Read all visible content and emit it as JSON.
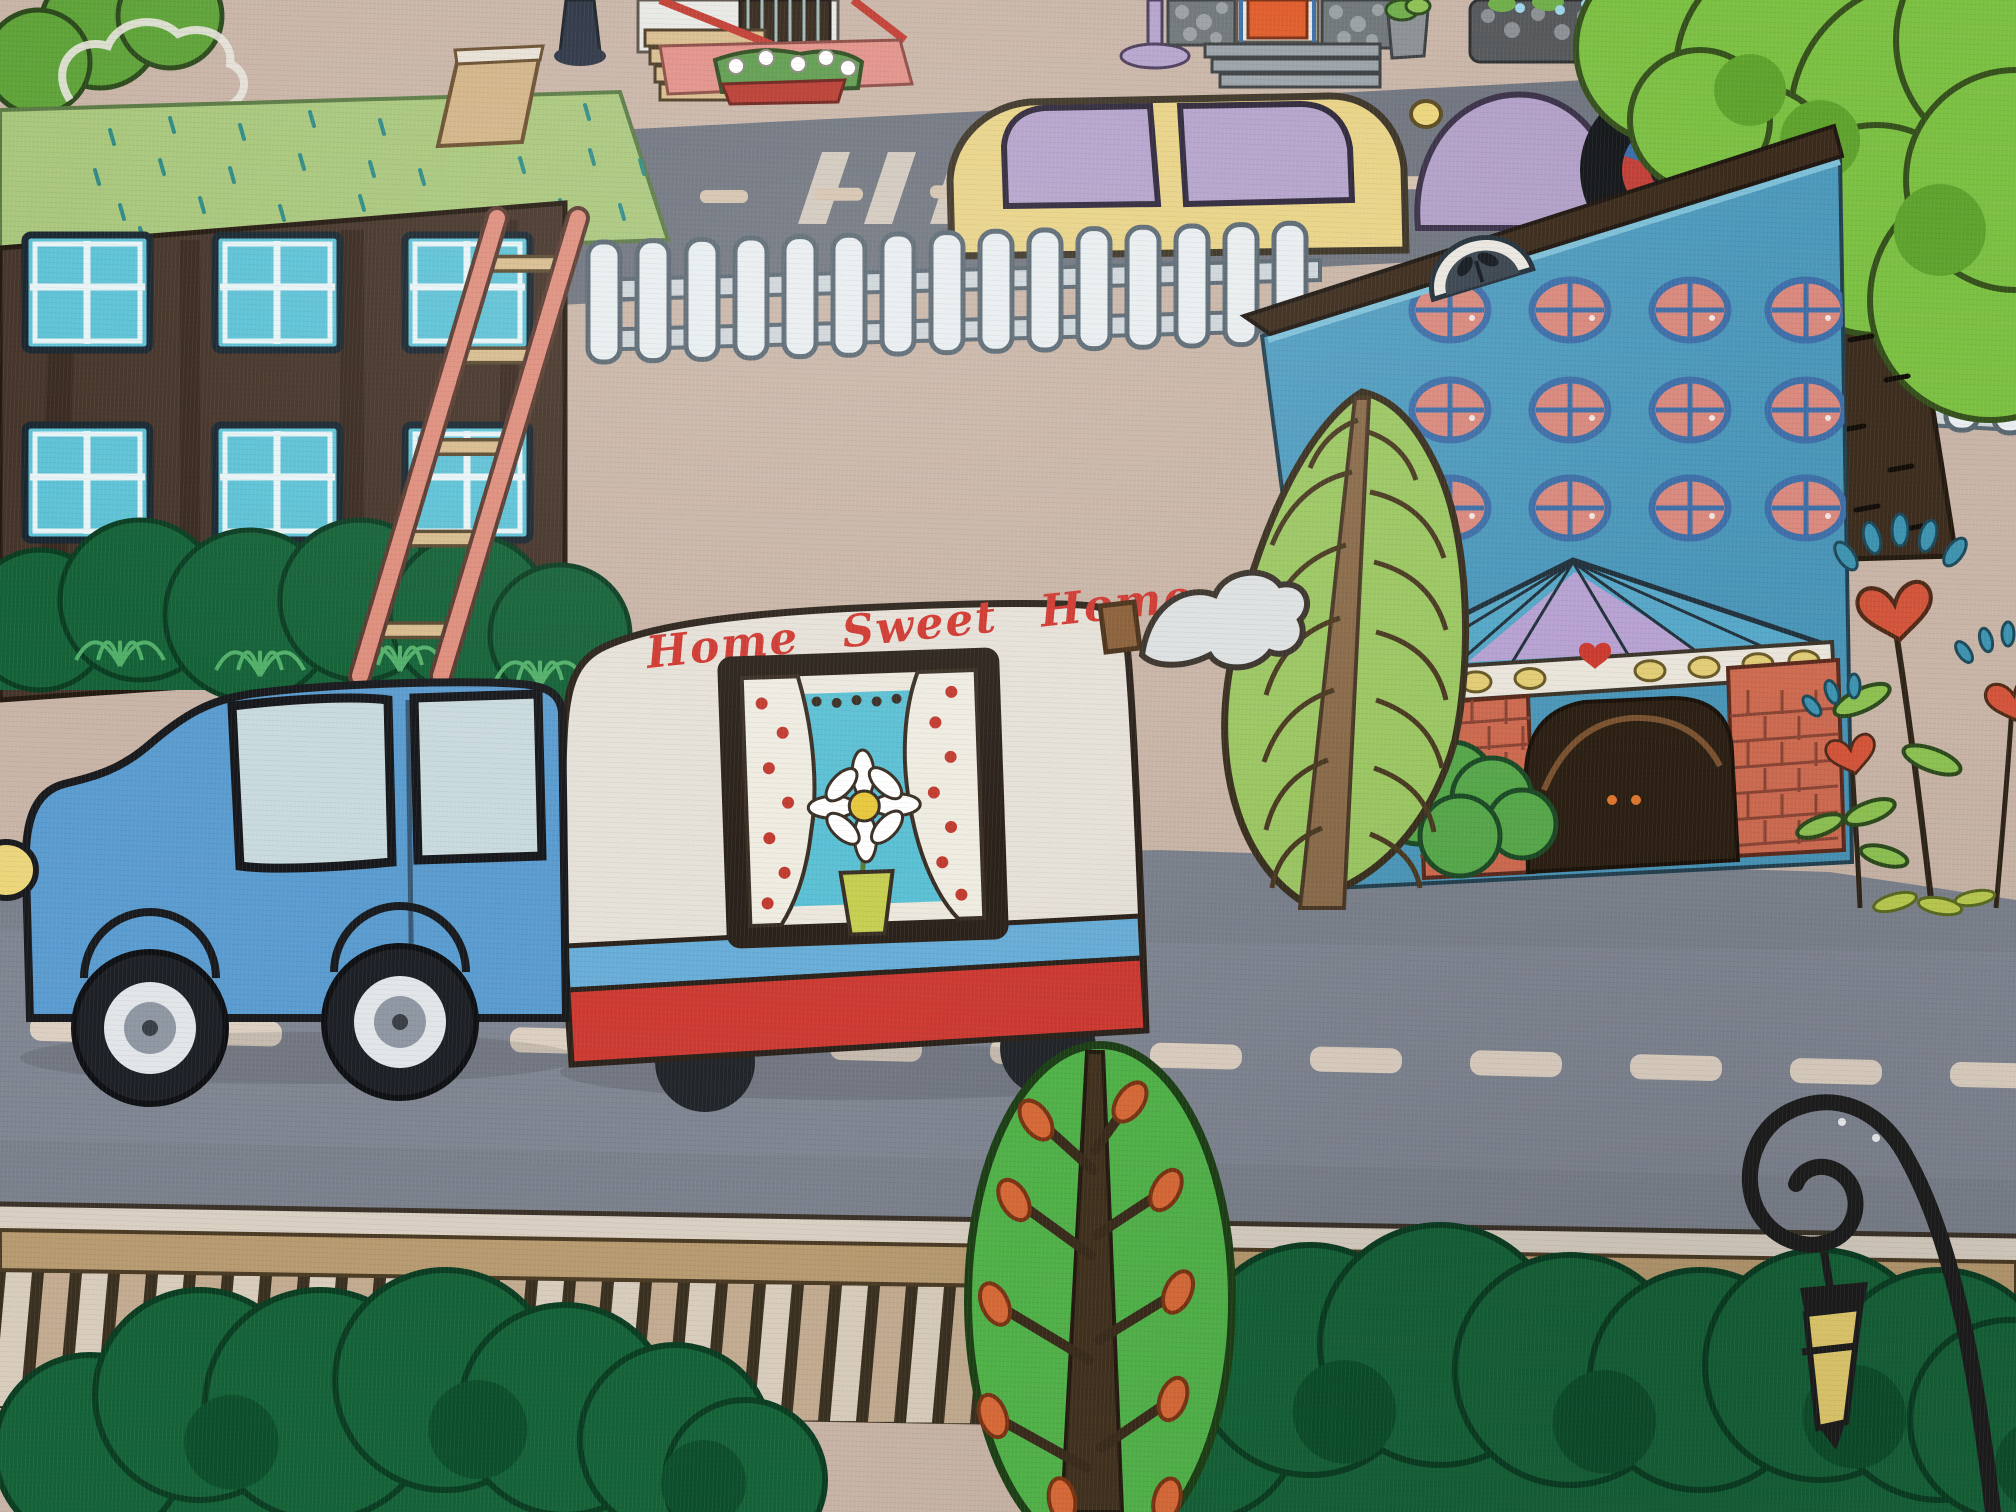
{
  "image": {
    "description": "Photograph of a children's city-themed play rug taken at an angle",
    "style": "cartoon town print on soft velour carpet"
  },
  "camper": {
    "side_text": "Home Sweet Home"
  },
  "palette": {
    "carpet": "#c9b5a7",
    "road": "#7b818c",
    "road_dash": "#ddd0c2",
    "lawn": "#a9c77c",
    "lawn_dash": "#2e8b86",
    "path_tan": "#d3b487",
    "building_brown": "#46352a",
    "window_cyan": "#5ec2d6",
    "ladder_pink": "#de8e7c",
    "rung_tan": "#d8bc8e",
    "bush_dark": "#156238",
    "bush_light": "#7cc254",
    "fence_white": "#e9eef0",
    "fence_rail": "#cfd6da",
    "car_yellow": "#e9d386",
    "car_window_lavender": "#b4a2cb",
    "car_purple": "#b2a0c8",
    "truck_blue": "#5b9cd0",
    "truck_window": "#c9dade",
    "camper_cream": "#e6e1d8",
    "camper_red_band": "#cc3a32",
    "camper_blue_stripe": "#68aed8",
    "camper_text_red": "#d03830",
    "curtain_teal": "#5cc0d4",
    "vase_green": "#c6cf52",
    "building_blue": "#4d9abc",
    "porthole_pink": "#d9897d",
    "porthole_frame_blue": "#3f6fa8",
    "roof_brown": "#3b2b1c",
    "pediment_lavender": "#b7a2d2",
    "beam_white": "#e9e5db",
    "beam_oval_yellow": "#e2cd76",
    "lantern_orange": "#e8863f",
    "lantern_pane_yellow": "#ecd170",
    "brick_salmon": "#cd6a50",
    "arch_dark": "#2c1f13",
    "leaf_tree_green": "#9cc763",
    "leaf_trunk_brown": "#8a6b4a",
    "heart_red": "#d2543a",
    "drop_blue": "#3e93b0",
    "big_tree_green": "#7cc043",
    "big_tree_trunk": "#3c2d1f",
    "boardwalk_rail": "#b79a70",
    "slat_cream": "#d8ccbc",
    "slat_tan": "#c2ab90",
    "bottom_tree_green": "#52b44a",
    "bud_orange": "#d96a38",
    "lamppost_black": "#1d1d1d",
    "post_lantern_yellow": "#e8d070",
    "smoke_white": "#dde1e2",
    "stone_gray": "#6f7678",
    "door_orange": "#e05a28",
    "porch_pink": "#e29088",
    "stair_rail_red": "#c23b30",
    "street_lamp_purple": "#b5a3cc",
    "bollard_navy": "#2c3444"
  },
  "objects": {
    "vehicles": [
      "blue pickup truck",
      "cream camper trailer with red stripe",
      "yellow car with purple windows",
      "purple car"
    ],
    "buildings": [
      "dark brown apartment with blue windows",
      "blue hotel with round pink windows and brick arch entrance",
      "porch house with red stair railings and flower box",
      "stone house with orange door"
    ],
    "nature": [
      "white picket fence",
      "dark green bushes",
      "leaf-shaped tree",
      "round tree with orange buds",
      "big tree with dark trunk",
      "heart-shaped flowers"
    ],
    "street": [
      "gray roads with dashed center lines",
      "crosswalk bars",
      "wooden boardwalk",
      "curled iron lamppost with yellow lantern",
      "purple street lamp",
      "pink ladder",
      "smoke puff"
    ]
  }
}
